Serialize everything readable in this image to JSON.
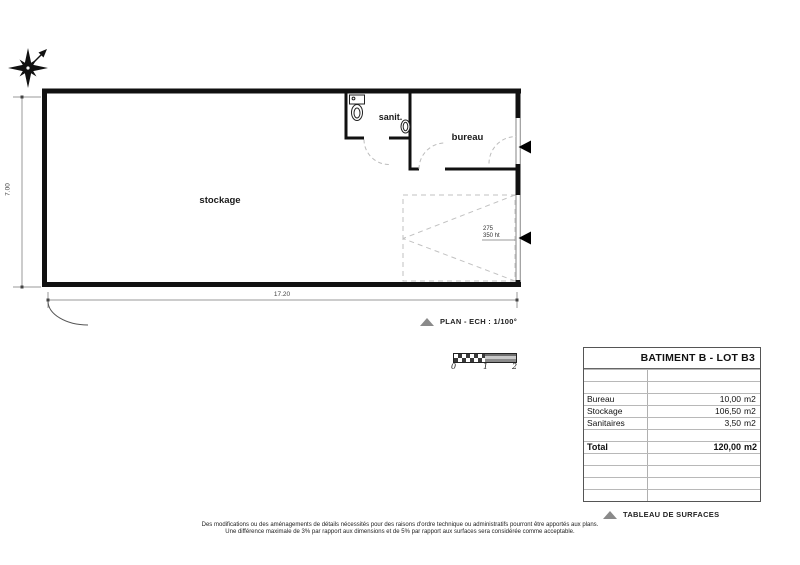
{
  "plan": {
    "rooms": {
      "stockage": "stockage",
      "sanit": "sanit.",
      "bureau": "bureau"
    },
    "garage_door_note": {
      "line1": "275",
      "line2": "350 ht"
    },
    "dimensions": {
      "height": "7.00",
      "width": "17.20"
    }
  },
  "plan_caption": {
    "label": "PLAN - ECH : 1/100°"
  },
  "scale_bar": {
    "ticks": [
      "0",
      "1",
      "2"
    ]
  },
  "surface_table": {
    "title": "BATIMENT B - LOT B3",
    "rows": [
      {
        "label": "Bureau",
        "value": "10,00",
        "unit": "m2"
      },
      {
        "label": "Stockage",
        "value": "106,50",
        "unit": "m2"
      },
      {
        "label": "Sanitaires",
        "value": "3,50",
        "unit": "m2"
      }
    ],
    "total": {
      "label": "Total",
      "value": "120,00",
      "unit": "m2"
    }
  },
  "table_caption": {
    "label": "TABLEAU DE SURFACES"
  },
  "footnote": {
    "line1": "Des modifications ou des aménagements de détails nécessités pour des raisons d'ordre technique ou administratifs pourront être apportés aux plans.",
    "line2": "Une différence maximale de 3% par rapport aux dimensions et de 5% par rapport aux surfaces sera considérée comme acceptable."
  },
  "colors": {
    "wall": "#111111",
    "opening_frame": "#9a9a9a",
    "dashed": "#bcbcbc",
    "dimension": "#999999",
    "marker_triangle": "#8a8a8a"
  }
}
